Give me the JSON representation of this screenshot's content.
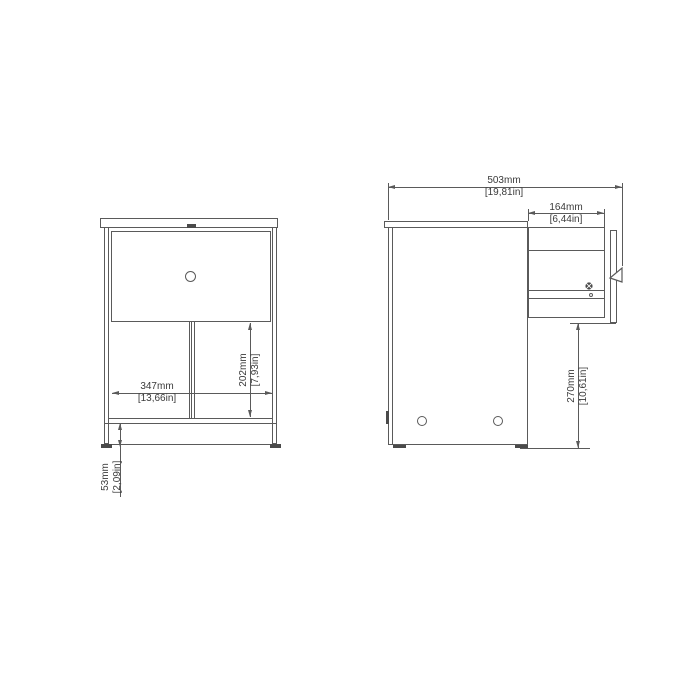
{
  "drawing": {
    "description": "furniture-technical-drawing",
    "colors": {
      "line": "#5a5a5a",
      "text": "#3a3a3a",
      "fill": "#4a4a4a",
      "background": "#ffffff"
    },
    "views": {
      "front": {
        "dims": {
          "width": {
            "mm": "347mm",
            "inch": "[13,66in]"
          },
          "opening_height": {
            "mm": "202mm",
            "inch": "[7,93in]"
          },
          "leg_height": {
            "mm": "53mm",
            "inch": "[2,09in]"
          }
        }
      },
      "side": {
        "dims": {
          "total_depth": {
            "mm": "503mm",
            "inch": "[19,81in]"
          },
          "drawer_extension": {
            "mm": "164mm",
            "inch": "[6,44in]"
          },
          "floor_clearance": {
            "mm": "270mm",
            "inch": "[10,61in]"
          }
        }
      }
    }
  }
}
